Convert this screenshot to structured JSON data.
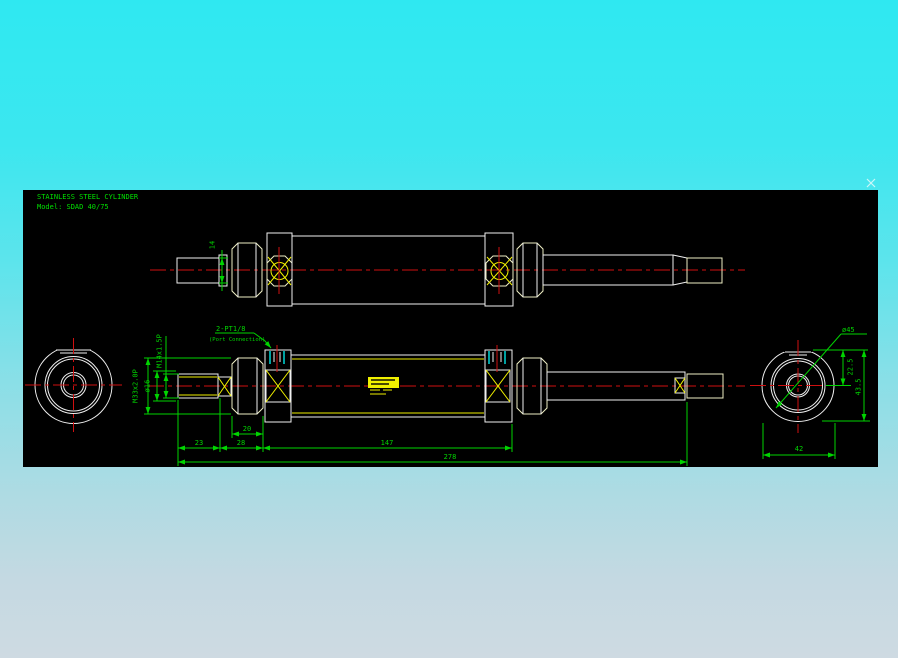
{
  "drawing": {
    "title_line1": "STAINLESS STEEL CYLINDER",
    "title_line2": "Model: SDAD 40/75"
  },
  "dimensions": {
    "rod_end_dia_top": "14",
    "port": "2-PT1/8",
    "port_note": "(Port Connection)",
    "collar_thread": "M33x2.0P",
    "rod_end_thread": "M14x1.5P",
    "rod_dia": "ø16",
    "nut_width": "20",
    "rod_protrusion": "23",
    "head_length": "28",
    "body_length": "147",
    "total_length": "278",
    "cap_dia": "ø45",
    "port_offset": "22.5",
    "cap_height": "43.5",
    "cap_width": "42"
  },
  "colors": {
    "canvas_background": "#000000",
    "outline_white": "#f0f0f0",
    "detail_yellow": "#f0f000",
    "centerline_red": "#cf1010",
    "dimension_green": "#00d400",
    "port_tick_cyan": "#00e8e8",
    "desktop_top": "#2fe8f1",
    "desktop_bottom": "#cedae2"
  }
}
